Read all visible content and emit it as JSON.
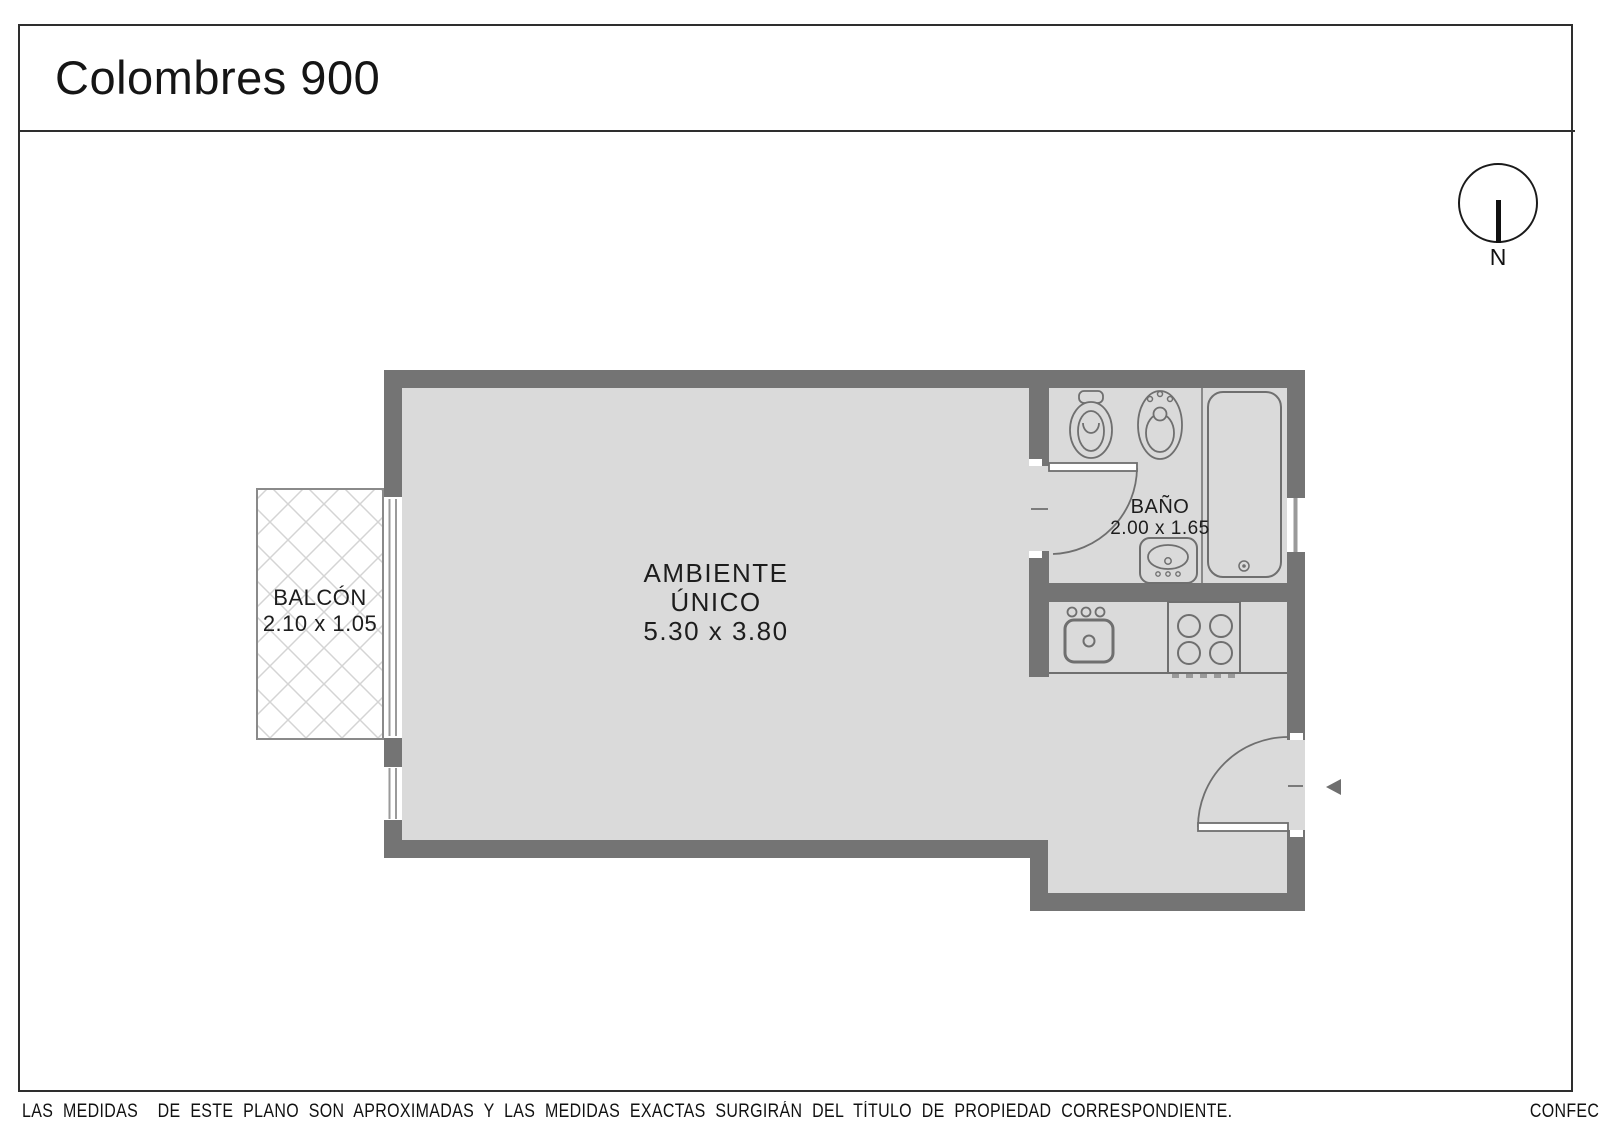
{
  "title": "Colombres 900",
  "compass": {
    "label": "N"
  },
  "rooms": {
    "main": {
      "name": "AMBIENTE",
      "name2": "ÚNICO",
      "dims": "5.30 x 3.80"
    },
    "balcony": {
      "name": "BALCÓN",
      "dims": "2.10 x 1.05"
    },
    "bathroom": {
      "name": "BAÑO",
      "dims": "2.00 x 1.65"
    }
  },
  "fixtures": [
    "toilet",
    "bidet",
    "bathtub",
    "bathroom-sink",
    "kitchen-sink",
    "stove"
  ],
  "doors": [
    "bathroom-door",
    "entry-door"
  ],
  "windows": [
    "balcony-slider",
    "left-window",
    "bathroom-window"
  ],
  "footer": {
    "disclaimer": "LAS MEDIDAS  DE ESTE PLANO SON APROXIMADAS Y LAS MEDIDAS EXACTAS SURGIRÁN DEL TÍTULO DE PROPIEDAD CORRESPONDIENTE.",
    "credit": "CONFECCIONADO POR ESTUDIO NARTEX"
  },
  "colors": {
    "wall": "#747474",
    "floor": "#dadada",
    "outline": "#6f6f6f",
    "frame": "#9a9a9a",
    "hatch": "#d4d4d4",
    "balcony_border": "#8a8a8a",
    "ink": "#1a1a1a"
  }
}
